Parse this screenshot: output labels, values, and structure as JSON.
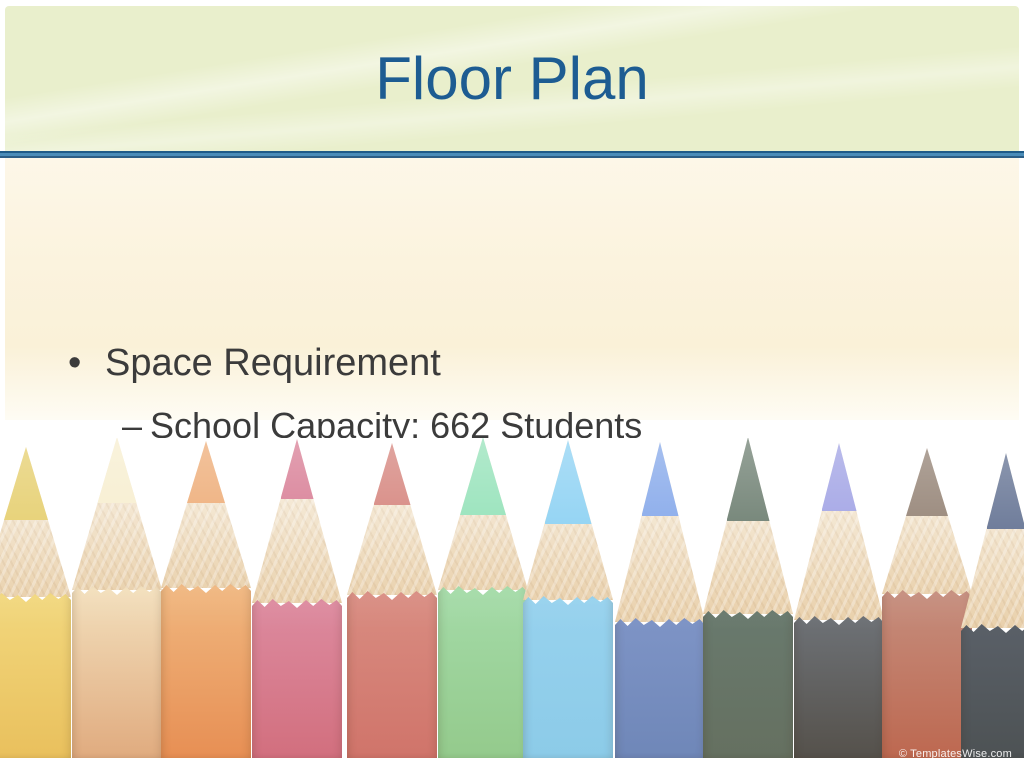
{
  "slide": {
    "title": "Floor Plan",
    "bullets": [
      {
        "level": 1,
        "marker": "•",
        "text": "Space Requirement"
      },
      {
        "level": 2,
        "marker": "–",
        "text": "School Capacity: 662 Students"
      },
      {
        "level": 2,
        "marker": "–",
        "text": "Total Square Footage: 4,150"
      },
      {
        "level": 2,
        "marker": "–",
        "text": "Main Resource Area: 1,800"
      }
    ]
  },
  "theme": {
    "title_color": "#1d5c92",
    "body_text_color": "#3b3b3b",
    "header_bg": "#e9efcc",
    "content_bg": "#fbf3de",
    "divider_blue": "#4a8cb8",
    "divider_dark": "#1f5b88",
    "wood_light": "#f7eedd",
    "wood_dark": "#e9d0ab"
  },
  "pencils_image": {
    "credit": "© TemplatesWise.com",
    "pencils": [
      {
        "name": "yellow",
        "cx": 26,
        "tip_top": 447,
        "body_top": 597,
        "tip_len": 73,
        "tip_color": "#e3ca61",
        "body_color_top": "#f2d87e",
        "body_color_bottom": "#e9c05d"
      },
      {
        "name": "cream",
        "cx": 117,
        "tip_top": 437,
        "body_top": 590,
        "tip_len": 66,
        "tip_color": "#f6ecca",
        "body_color_top": "#f3e0bd",
        "body_color_bottom": "#e0ab7f"
      },
      {
        "name": "orange",
        "cx": 206,
        "tip_top": 441,
        "body_top": 588,
        "tip_len": 62,
        "tip_color": "#eca46a",
        "body_color_top": "#f0b77f",
        "body_color_bottom": "#e78f54"
      },
      {
        "name": "pink",
        "cx": 297,
        "tip_top": 439,
        "body_top": 603,
        "tip_len": 60,
        "tip_color": "#d4708a",
        "body_color_top": "#dd8ba0",
        "body_color_bottom": "#d26f7e"
      },
      {
        "name": "red",
        "cx": 392,
        "tip_top": 443,
        "body_top": 595,
        "tip_len": 62,
        "tip_color": "#d17870",
        "body_color_top": "#d98d82",
        "body_color_bottom": "#d0746a"
      },
      {
        "name": "mint-green",
        "cx": 483,
        "tip_top": 437,
        "body_top": 590,
        "tip_len": 78,
        "tip_color": "#8adfb2",
        "body_color_top": "#a4dba8",
        "body_color_bottom": "#94ca8c"
      },
      {
        "name": "sky-blue",
        "cx": 568,
        "tip_top": 440,
        "body_top": 600,
        "tip_len": 84,
        "tip_color": "#82cdf2",
        "body_color_top": "#97d2ee",
        "body_color_bottom": "#8ccbe8"
      },
      {
        "name": "blue",
        "cx": 660,
        "tip_top": 442,
        "body_top": 622,
        "tip_len": 74,
        "tip_color": "#7aa0e8",
        "body_color_top": "#7e94c6",
        "body_color_bottom": "#6f87b8"
      },
      {
        "name": "dark-green",
        "cx": 748,
        "tip_top": 437,
        "body_top": 614,
        "tip_len": 84,
        "tip_color": "#5f7263",
        "body_color_top": "#697a6e",
        "body_color_bottom": "#657060"
      },
      {
        "name": "violet",
        "cx": 839,
        "tip_top": 443,
        "body_top": 620,
        "tip_len": 68,
        "tip_color": "#989ae2",
        "body_color_top": "#6e7277",
        "body_color_bottom": "#55514b"
      },
      {
        "name": "brown",
        "cx": 927,
        "tip_top": 448,
        "body_top": 594,
        "tip_len": 68,
        "tip_color": "#8a7768",
        "body_color_top": "#c58e7e",
        "body_color_bottom": "#bd6850"
      },
      {
        "name": "navy",
        "cx": 1006,
        "tip_top": 453,
        "body_top": 628,
        "tip_len": 76,
        "tip_color": "#57678a",
        "body_color_top": "#5a6068",
        "body_color_bottom": "#4d5254"
      }
    ]
  }
}
